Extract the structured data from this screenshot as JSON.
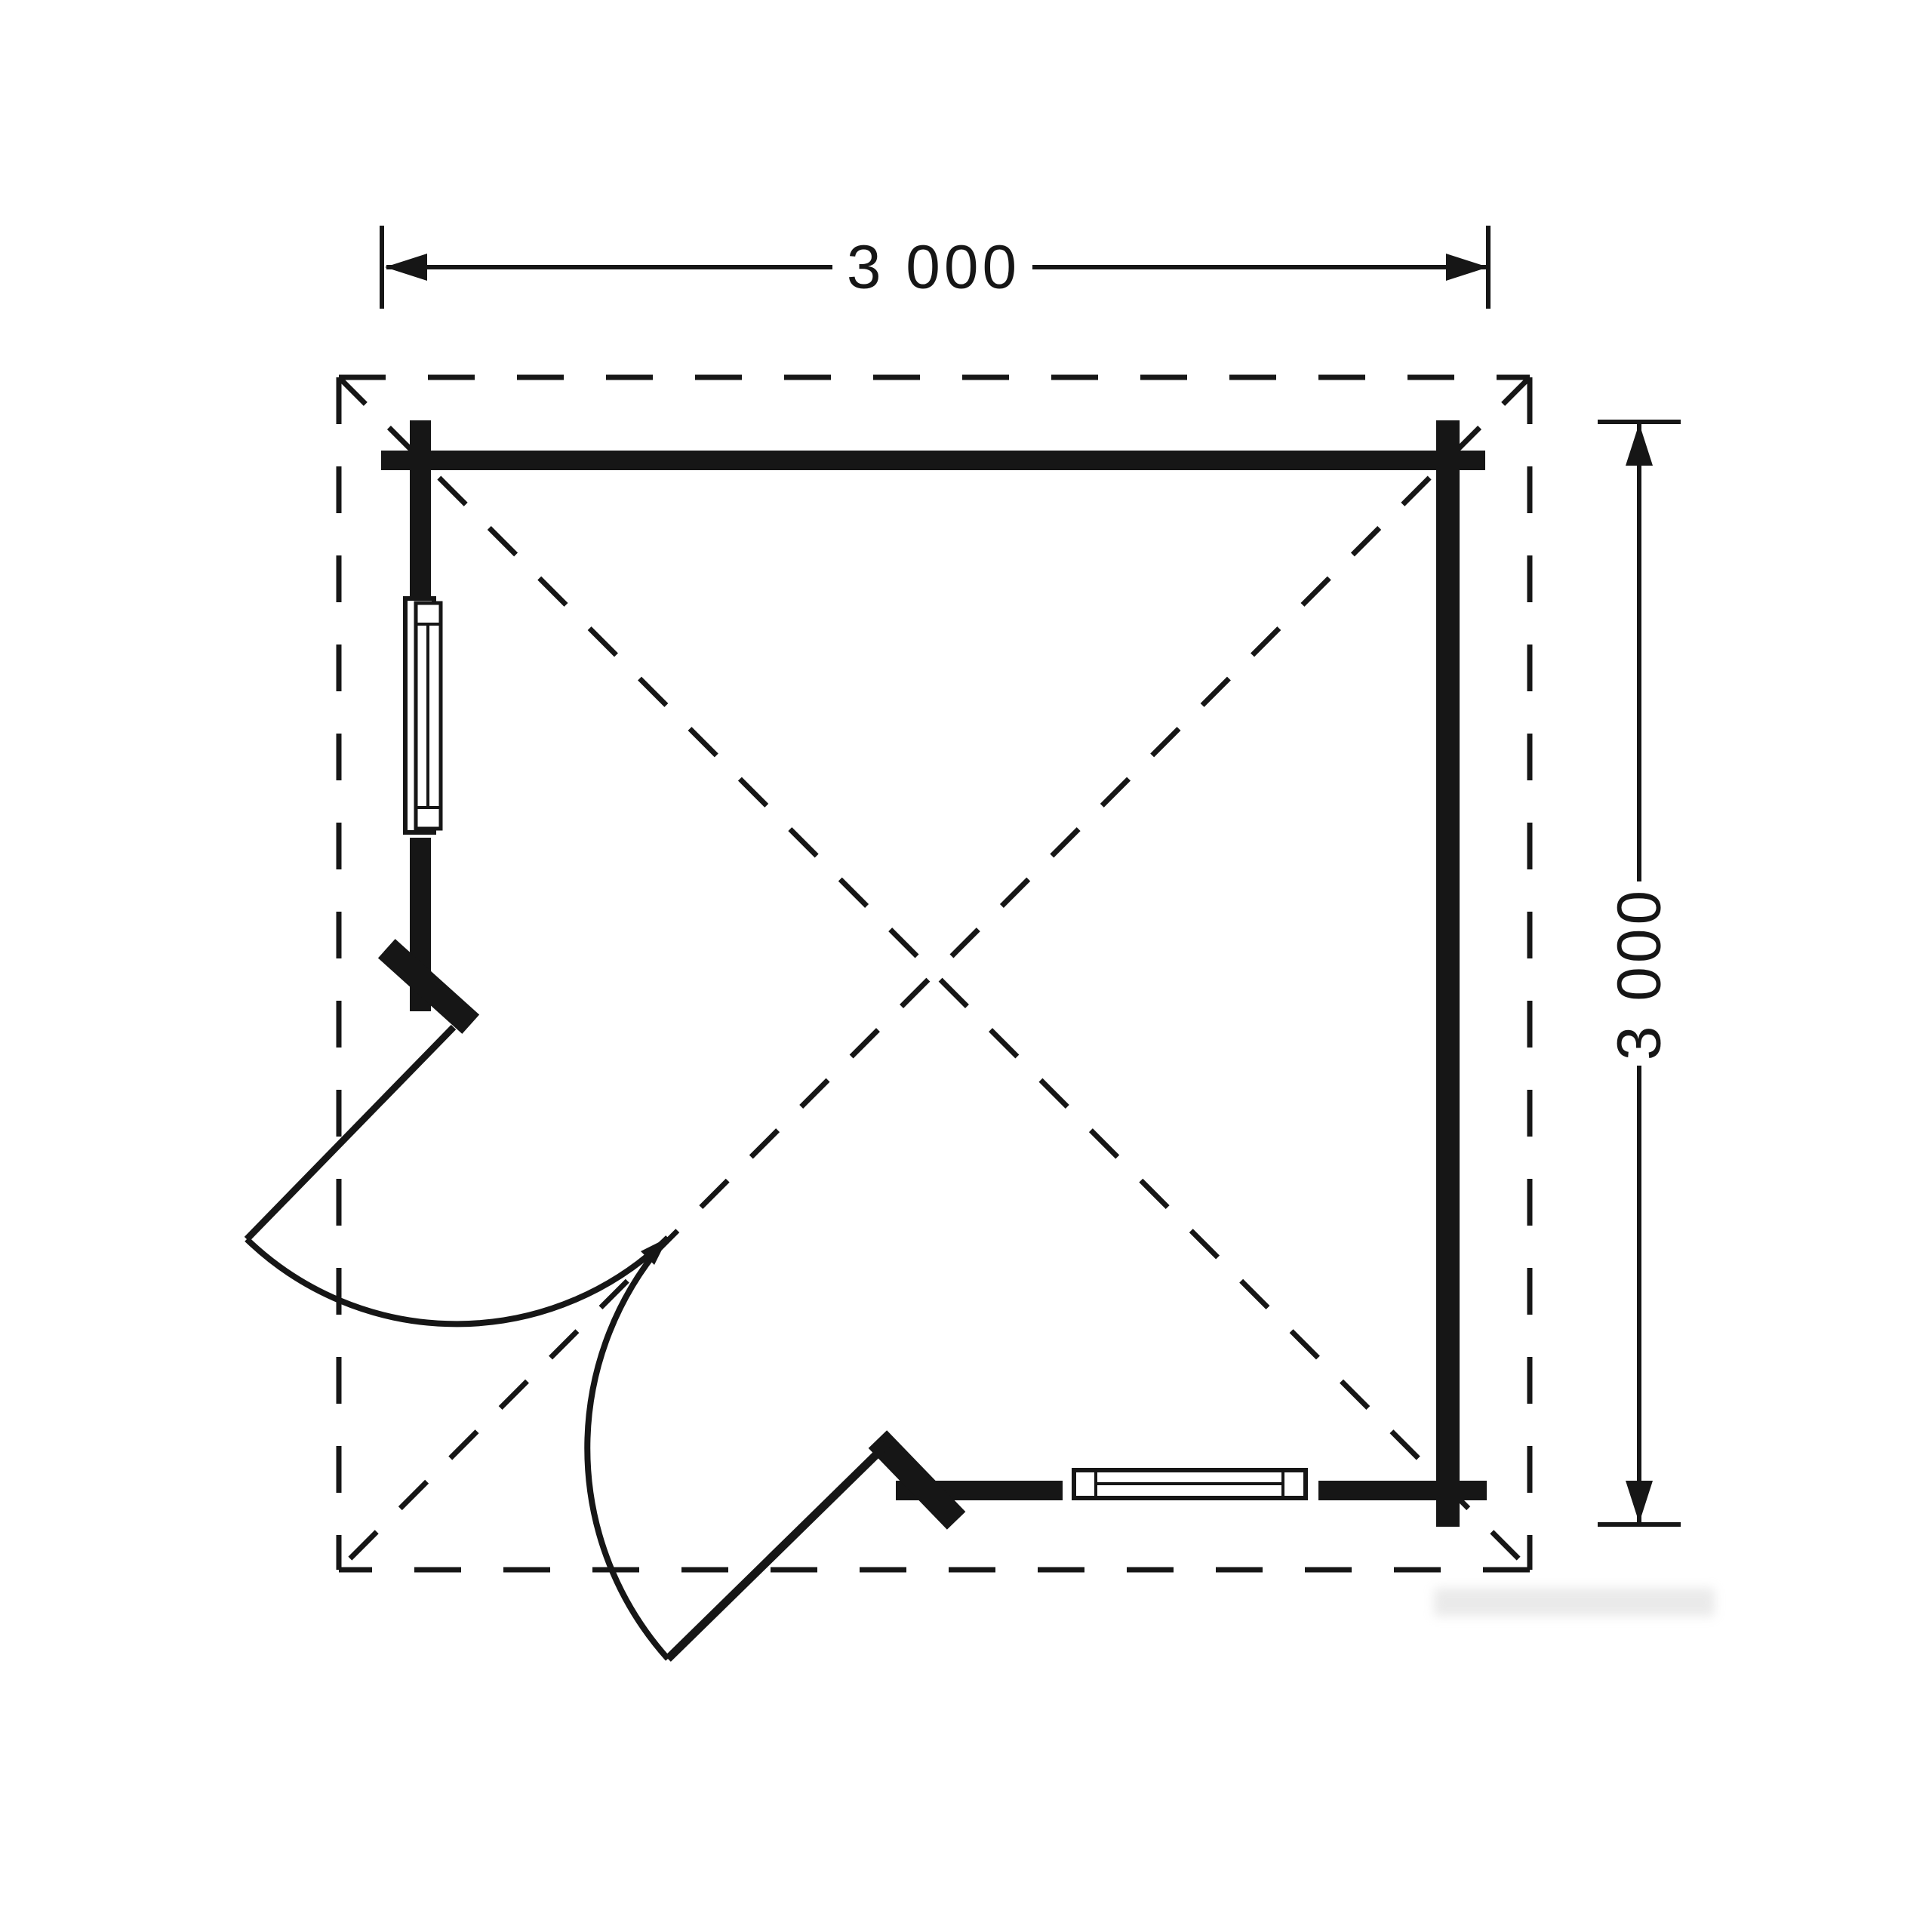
{
  "document": {
    "kind": "log-cabin floor plan drawing",
    "background": "#ffffff"
  },
  "dimensions": {
    "width": {
      "label": "3 000"
    },
    "depth": {
      "label": "3 000"
    }
  },
  "features": {
    "windows": [
      "left-wall window",
      "bottom-wall window"
    ],
    "doors": [
      "corner double door leaf left",
      "corner double door leaf bottom"
    ],
    "roof": "dashed overhang outline with diagonal ridge lines"
  },
  "colors": {
    "line": "#161616",
    "background": "#ffffff",
    "watermark": "#c9c9c9"
  }
}
